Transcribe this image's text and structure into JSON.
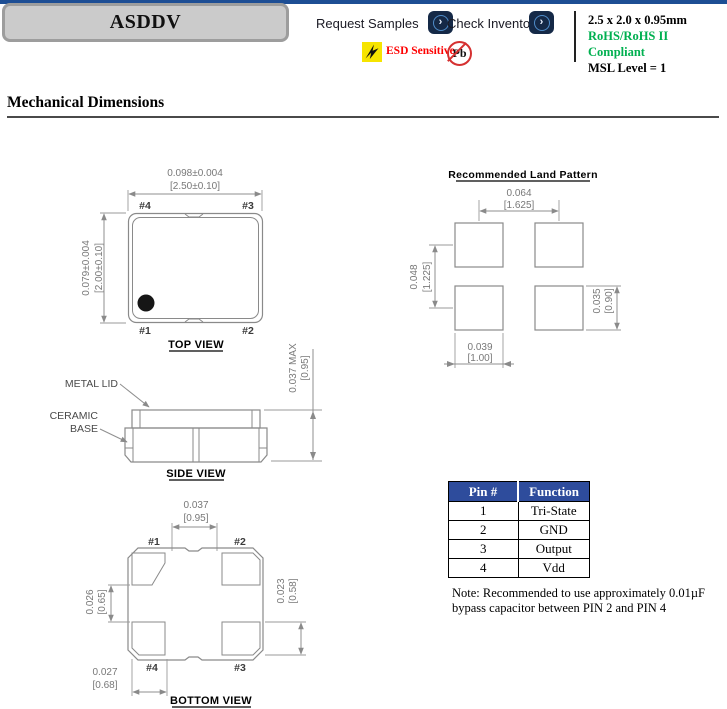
{
  "header": {
    "product_title": "ASDDV",
    "request_samples": "Request Samples",
    "check_inventory": "Check Inventory",
    "esd_label": "ESD Sensitive",
    "pb_label": "Pb",
    "size": "2.5 x 2.0 x 0.95mm",
    "rohs": "RoHS/RoHS II Compliant",
    "msl": "MSL Level = 1"
  },
  "colors": {
    "top_bar_blue": "#1d4e94",
    "table_header_blue": "#2e4c9c",
    "rohs_green": "#00b050",
    "esd_red": "#fe0000",
    "nav_button_navy": "#152947"
  },
  "section_title": "Mechanical Dimensions",
  "top_view": {
    "title": "TOP VIEW",
    "dim_width_in": "0.098±0.004",
    "dim_width_mm": "[2.50±0.10]",
    "dim_height_in": "0.079±0.004",
    "dim_height_mm": "[2.00±0.10]",
    "pin_tl": "#4",
    "pin_tr": "#3",
    "pin_bl": "#1",
    "pin_br": "#2"
  },
  "land_pattern": {
    "title": "Recommended Land Pattern",
    "pitch_x_in": "0.064",
    "pitch_x_mm": "[1.625]",
    "pitch_y_in": "0.048",
    "pitch_y_mm": "[1.225]",
    "pad_h_in": "0.035",
    "pad_h_mm": "[0.90]",
    "pad_w_in": "0.039",
    "pad_w_mm": "[1.00]"
  },
  "side_view": {
    "title": "SIDE VIEW",
    "metal_lid": "METAL LID",
    "ceramic": "CERAMIC",
    "base": "BASE",
    "height_in": "0.037 MAX",
    "height_mm": "[0.95]"
  },
  "bottom_view": {
    "title": "BOTTOM VIEW",
    "gap_in": "0.037",
    "gap_mm": "[0.95]",
    "left_in": "0.026",
    "left_mm": "[0.65]",
    "right_in": "0.023",
    "right_mm": "[0.58]",
    "pad_in": "0.027",
    "pad_mm": "[0.68]",
    "pin_tl": "#1",
    "pin_tr": "#2",
    "pin_bl": "#4",
    "pin_br": "#3"
  },
  "pin_table": {
    "headers": [
      "Pin #",
      "Function"
    ],
    "rows": [
      [
        "1",
        "Tri-State"
      ],
      [
        "2",
        "GND"
      ],
      [
        "3",
        "Output"
      ],
      [
        "4",
        "Vdd"
      ]
    ]
  },
  "note": {
    "line1": "Note: Recommended to use approximately 0.01µF",
    "line2": "bypass capacitor between PIN 2 and PIN 4"
  }
}
